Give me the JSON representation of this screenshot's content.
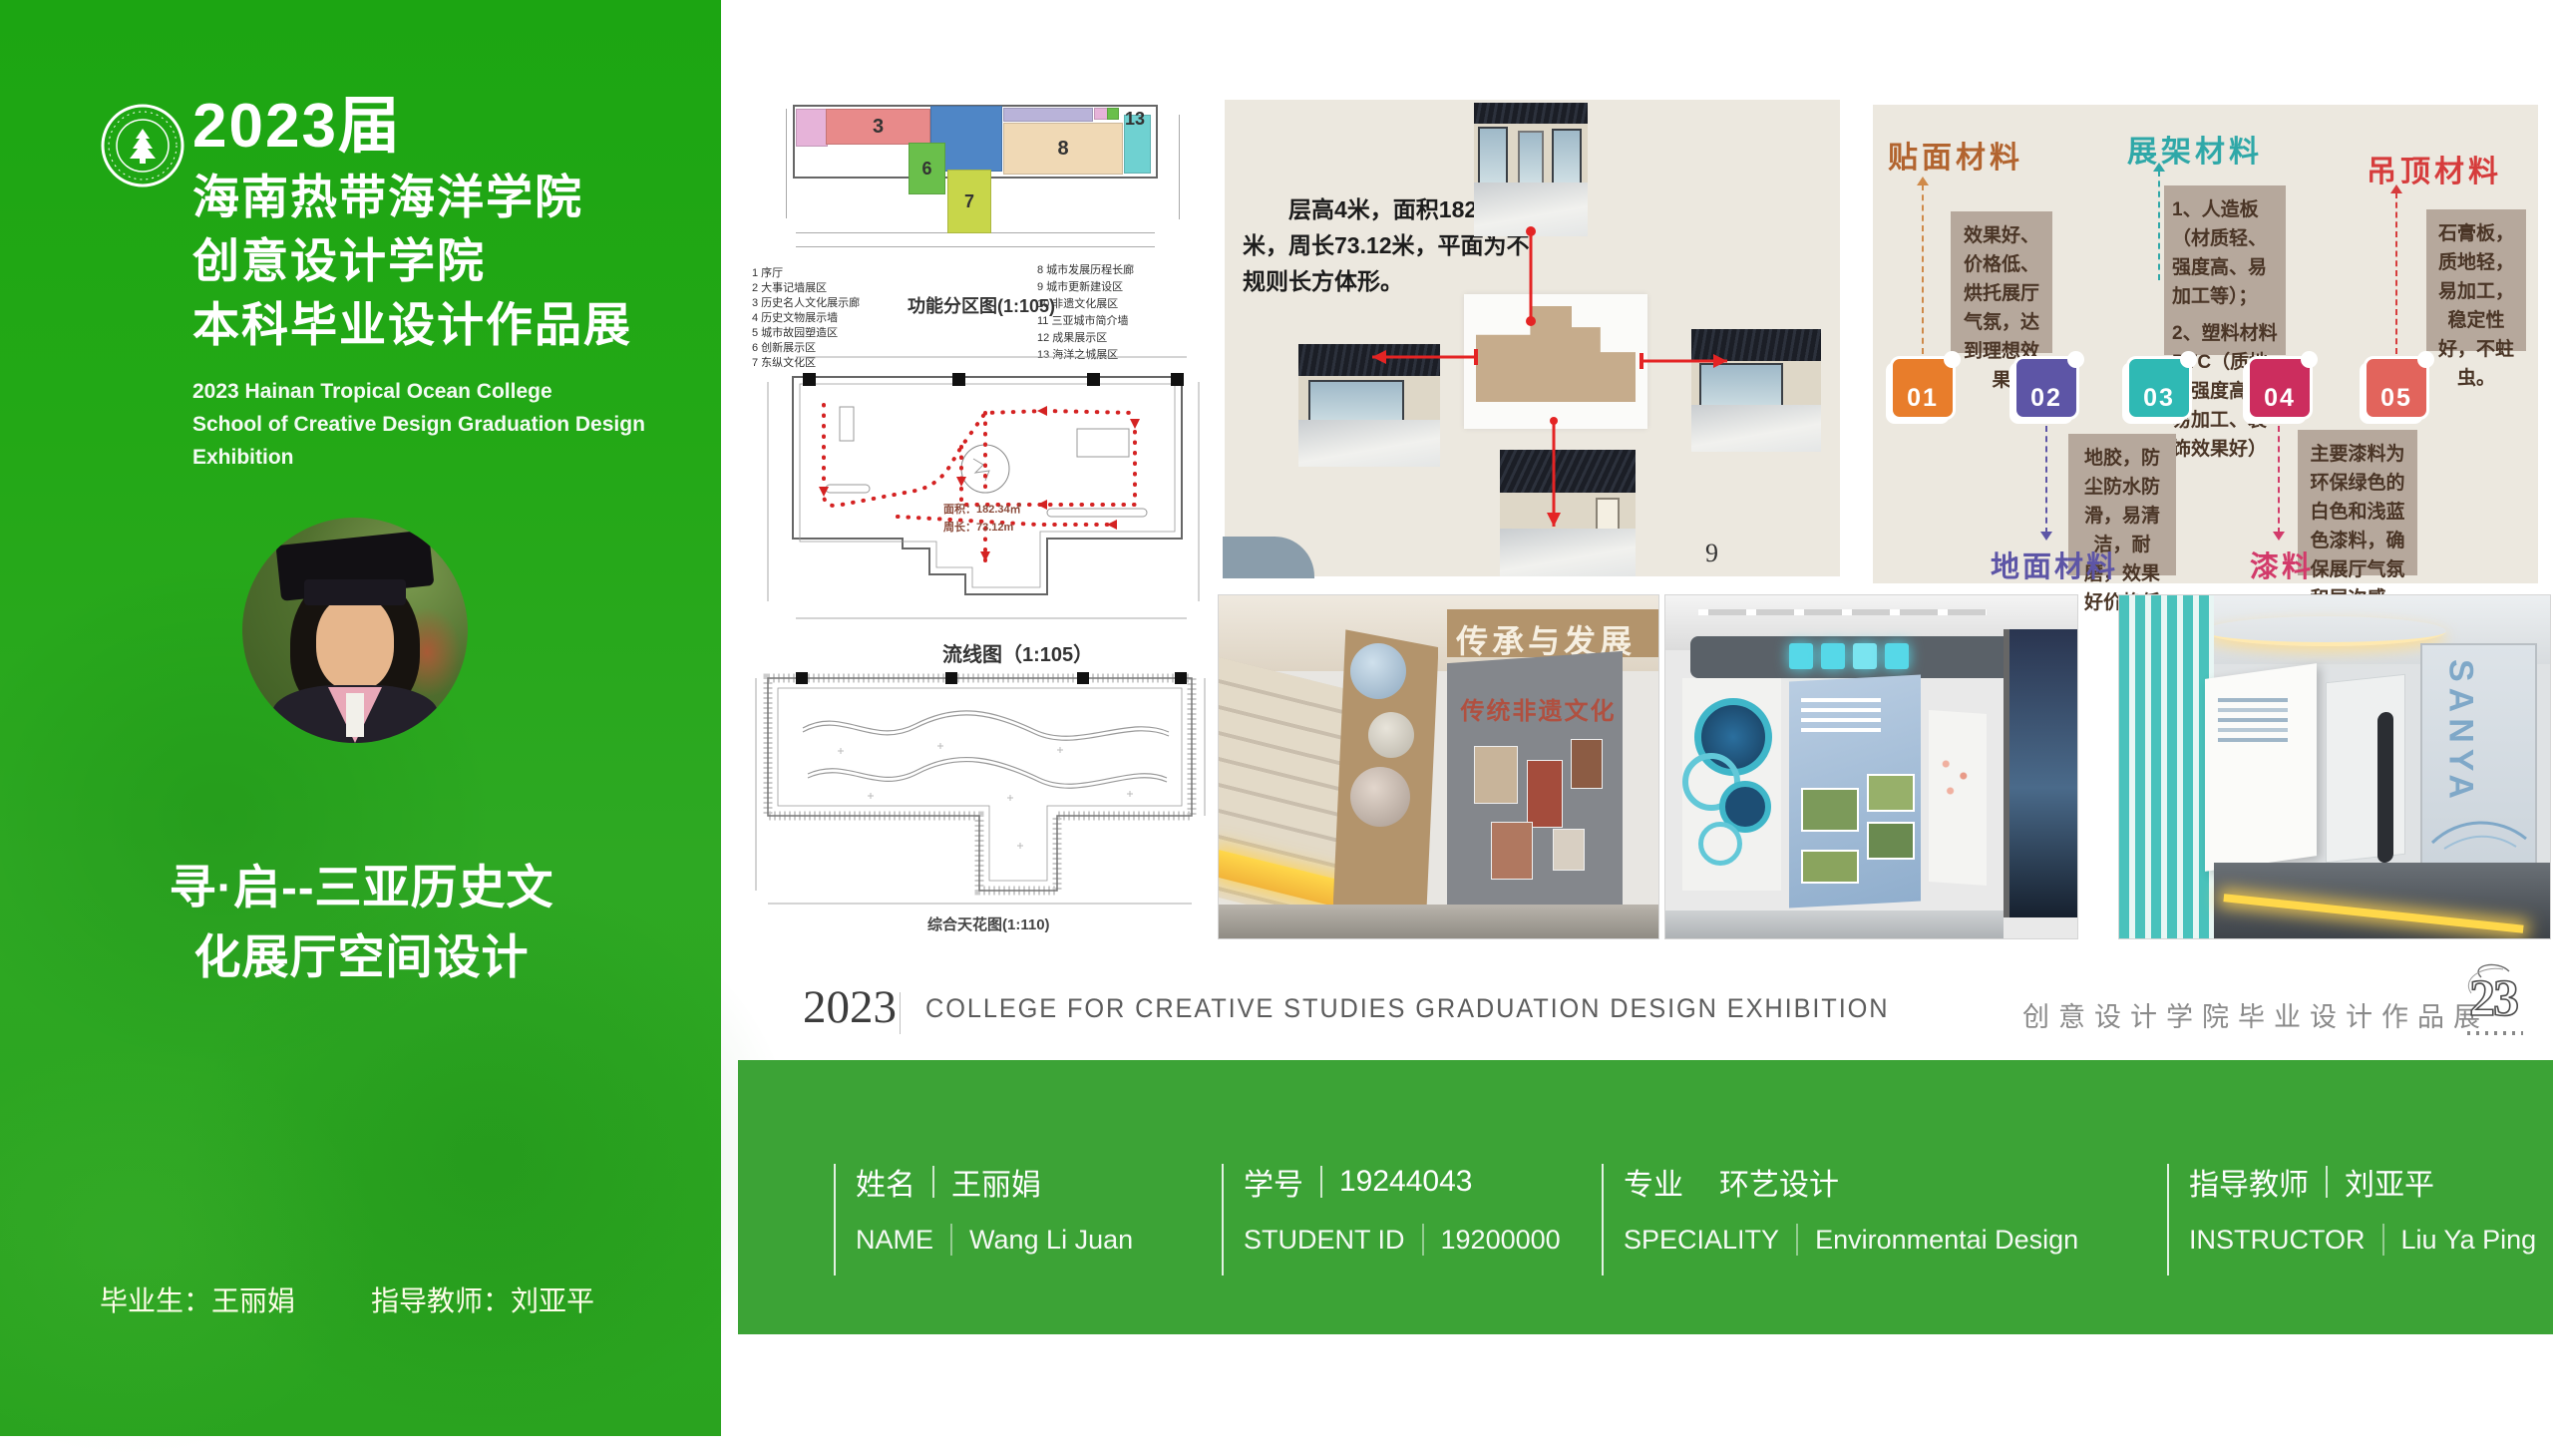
{
  "sidebar": {
    "year_title": "2023届",
    "school_line1": "海南热带海洋学院",
    "school_line2": "创意设计学院",
    "school_line3": "本科毕业设计作品展",
    "english_line1": "2023 Hainan Tropical Ocean College",
    "english_line2": "School of Creative Design Graduation Design Exhibition",
    "project_title_line1": "寻·启--三亚历史文",
    "project_title_line2": "化展厅空间设计",
    "graduate_label": "毕业生：王丽娟",
    "instructor_label": "指导教师：刘亚平",
    "accent_green": "#23a816"
  },
  "drawings": {
    "zoning": {
      "title": "功能分区图(1:105)",
      "zones": [
        {
          "num": "3",
          "color": "#e88a8a"
        },
        {
          "num": "6",
          "color": "#6abf4b"
        },
        {
          "num": "7",
          "color": "#c8d64a"
        },
        {
          "num": "8",
          "color": "#f0d9b5"
        },
        {
          "num": "13",
          "color": "#6fd1d1"
        }
      ],
      "legend_left": [
        "1 序厅",
        "2 大事记墙展区",
        "3 历史名人文化展示廊",
        "4 历史文物展示墙",
        "5 城市故园塑造区",
        "6 创新展示区",
        "7 东纵文化区"
      ],
      "legend_right": [
        "8 城市发展历程长廊",
        "9 城市更新建设区",
        "10 非遗文化展区",
        "11 三亚城市简介墙",
        "12 成果展示区",
        "13 海洋之城展区"
      ]
    },
    "circulation": {
      "title": "流线图（1:105）",
      "area_note": "面积：182.34㎡",
      "perimeter_note": "周长：73.12m"
    },
    "ceiling": {
      "title": "综合天花图(1:110)"
    }
  },
  "site": {
    "description": "层高4米，面积182.34平米，周长73.12米，平面为不规则长方体形。",
    "page_number": "9"
  },
  "materials": {
    "headers": [
      {
        "label": "贴面材料",
        "color": "#b2642f"
      },
      {
        "label": "展架材料",
        "color": "#2fa8a8"
      },
      {
        "label": "吊顶材料",
        "color": "#d63c3c"
      }
    ],
    "bottom_headers": [
      {
        "label": "地面材料",
        "color": "#5d55a6"
      },
      {
        "label": "漆料",
        "color": "#d23a6a"
      }
    ],
    "notes": {
      "veneer": "效果好、价格低、烘托展厅气氛，达到理想效果",
      "shelf_1": "1、人造板（材质轻、强度高、易加工等）；",
      "shelf_2": "2、塑料材料PVC（质地轻强度高、易加工、装饰效果好）",
      "ceiling": "石膏板，质地轻，易加工，稳定性好，不蛀虫。",
      "floor": "地胶，防尘防水防滑，易清洁，耐磨，效果好价格低",
      "paint": "主要漆料为环保绿色的白色和浅蓝色漆料，确保展厅气氛和层次感，"
    },
    "cards": [
      {
        "num": "01",
        "color": "#e87d2b"
      },
      {
        "num": "02",
        "color": "#5d55a6"
      },
      {
        "num": "03",
        "color": "#2fb9b4"
      },
      {
        "num": "04",
        "color": "#cc2d5e"
      },
      {
        "num": "05",
        "color": "#e2645c"
      }
    ]
  },
  "renders": [
    {
      "caption_main": "传承与发展",
      "caption_sub": "传统非遗文化"
    },
    {
      "note": "exhibition hall render"
    },
    {
      "sign_top": "SANYA",
      "sign_bottom": "POOL PARTY"
    }
  ],
  "banner": {
    "year": "2023",
    "english": "COLLEGE FOR CREATIVE STUDIES GRADUATION DESIGN EXHIBITION",
    "chinese": "创意设计学院毕业设计作品展",
    "logo": "23"
  },
  "footer": {
    "green": "#3ca336",
    "fields": [
      {
        "label_cn": "姓名",
        "value_cn": "王丽娟",
        "label_en": "NAME",
        "value_en": "Wang Li Juan"
      },
      {
        "label_cn": "学号",
        "value_cn": "19244043",
        "label_en": "STUDENT ID",
        "value_en": "19200000"
      },
      {
        "label_cn": "专业",
        "value_cn": "环艺设计",
        "label_en": "SPECIALITY",
        "value_en": "Environmentai  Design"
      },
      {
        "label_cn": "指导教师",
        "value_cn": "刘亚平",
        "label_en": "INSTRUCTOR",
        "value_en": "Liu Ya Ping"
      }
    ]
  }
}
